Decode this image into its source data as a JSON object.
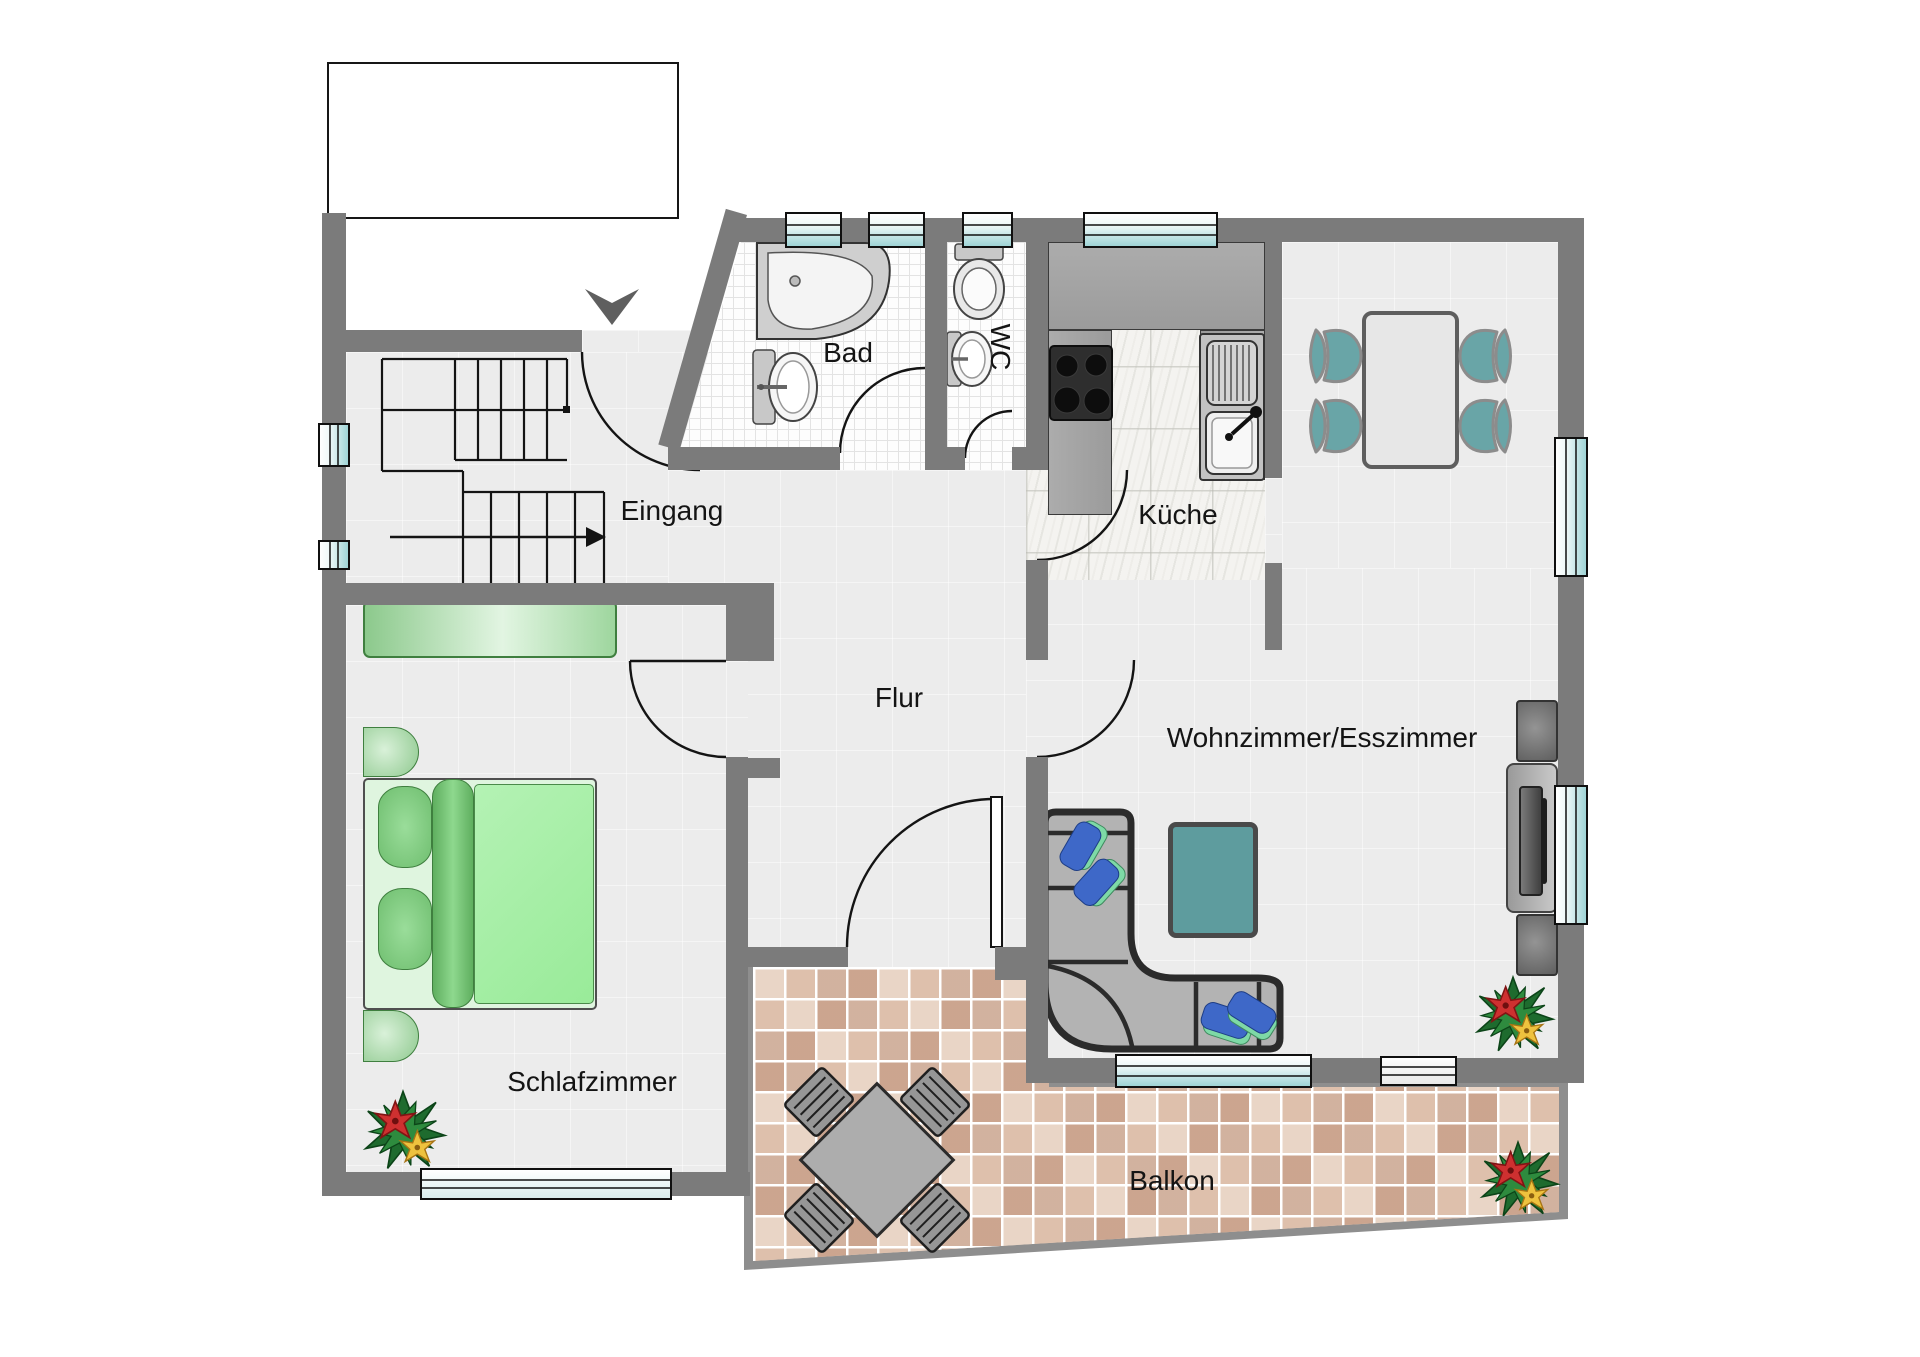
{
  "floorplan": {
    "type": "apartment-floor-plan",
    "rooms": {
      "eingang": {
        "label": "Eingang"
      },
      "bad": {
        "label": "Bad"
      },
      "wc": {
        "label": "WC"
      },
      "kueche": {
        "label": "Küche"
      },
      "flur": {
        "label": "Flur"
      },
      "wohnzimmer": {
        "label": "Wohnzimmer/Esszimmer"
      },
      "schlafzimmer": {
        "label": "Schlafzimmer"
      },
      "balkon": {
        "label": "Balkon"
      }
    },
    "furniture_symbols": [
      "stairs",
      "entry-arrow",
      "bathtub",
      "washbasin",
      "toilet",
      "stove",
      "kitchen-sink",
      "dining-table",
      "dining-chair",
      "sofa",
      "cushion",
      "coffee-table",
      "tv-lowboard",
      "speaker",
      "wardrobe",
      "bed",
      "pillow",
      "blanket",
      "nightstand",
      "balcony-table",
      "balcony-chair",
      "plant",
      "door-swing",
      "window"
    ],
    "colors": {
      "wall": "#7B7B7B",
      "floor": "#ECECEC",
      "bath_tile": "#FDFDFD",
      "kitchen_marble": "#F4F3F0",
      "window_glass": "#9FD4D6",
      "bedroom_green": "#8FCF8F",
      "mattress_green": "#A8EFA8",
      "dining_chair_teal": "#69A5A7",
      "coffee_table_teal": "#5E9C9E",
      "sofa_gray": "#B3B3B3",
      "sofa_outline": "#2B2B2B",
      "balcony_tile": "#DEC0AC",
      "balcony_grout": "#FFFFFF",
      "plant_leaf": "#1E6B2E",
      "plant_red": "#CE3030",
      "plant_yellow": "#EEC23E",
      "counter_gray": "#A3A3A3",
      "stove_black": "#1A1A1A"
    }
  }
}
